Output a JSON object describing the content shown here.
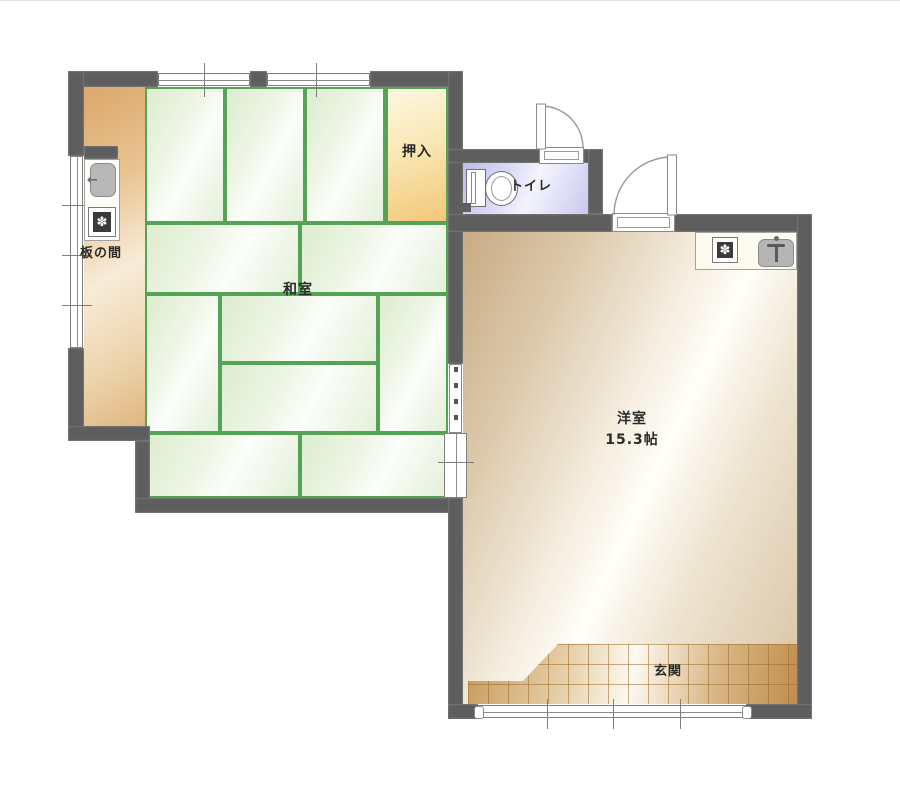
{
  "floorplan": {
    "type": "japanese-apartment-floor-plan",
    "rooms": {
      "washitsu": {
        "label": "和室",
        "floor": "tatami",
        "mats_drawn": 11
      },
      "oshiire": {
        "label": "押入"
      },
      "itanoma": {
        "label": "板の間"
      },
      "toilet": {
        "label": "トイレ"
      },
      "youshitsu": {
        "label": "洋室",
        "size": "15.3帖"
      },
      "genkan": {
        "label": "玄関"
      }
    },
    "fixtures": [
      "kitchen-sink",
      "kitchen-stove",
      "toilet",
      "gas-stove",
      "water-heater"
    ],
    "icon_glyphs": {
      "burner": "✽",
      "faucet": "←"
    },
    "colors": {
      "wall": "#5e5e5e",
      "tatami_border": "#55a355",
      "tatami_fill": "#e9f4df",
      "wood_floor": "#dfae72",
      "oshiire_fill": "#f4cb7c",
      "toilet_floor": "#c9c9ee",
      "western_floor": "#d9c5a4",
      "entrance_tile": "#c79e63"
    }
  }
}
